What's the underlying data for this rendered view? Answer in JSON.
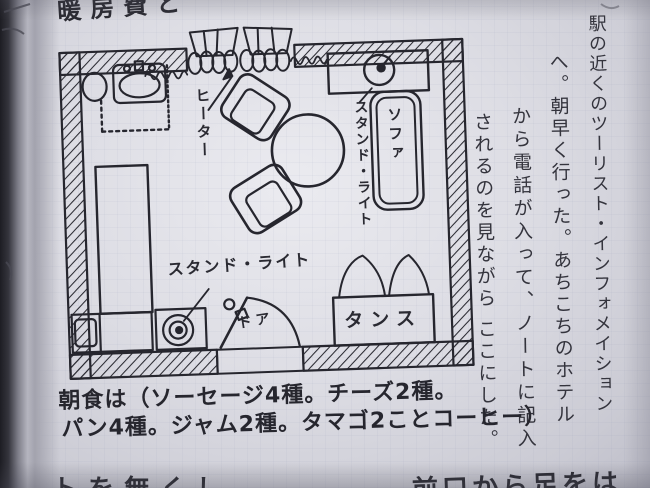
{
  "page": {
    "top_partial_text": "暖房費と",
    "bottom_partial_left": "トを無くし",
    "bottom_partial_right": "前口から足をは"
  },
  "plan": {
    "labels": {
      "heater": "ヒーター",
      "stand_light_top": "スタンド・ライト",
      "sofa": "ソファ",
      "tansu": "タンス",
      "stand_light_bottom": "スタンド・ライト",
      "door": "ドア"
    }
  },
  "journal": {
    "columns": [
      "駅の近くのツーリスト・インフォメイション",
      "へ。朝早く行った。あちこちのホテル",
      "から電話が入って、ノートに記入",
      "されるのを見ながら ここにした。"
    ]
  },
  "note": {
    "line1": "朝食は（ソーセージ4種。チーズ2種。",
    "line2": "パン4種。ジャム2種。タマゴ2ことコーヒー）"
  },
  "colors": {
    "ink": "#26262e",
    "paper": "#dcdce3"
  }
}
